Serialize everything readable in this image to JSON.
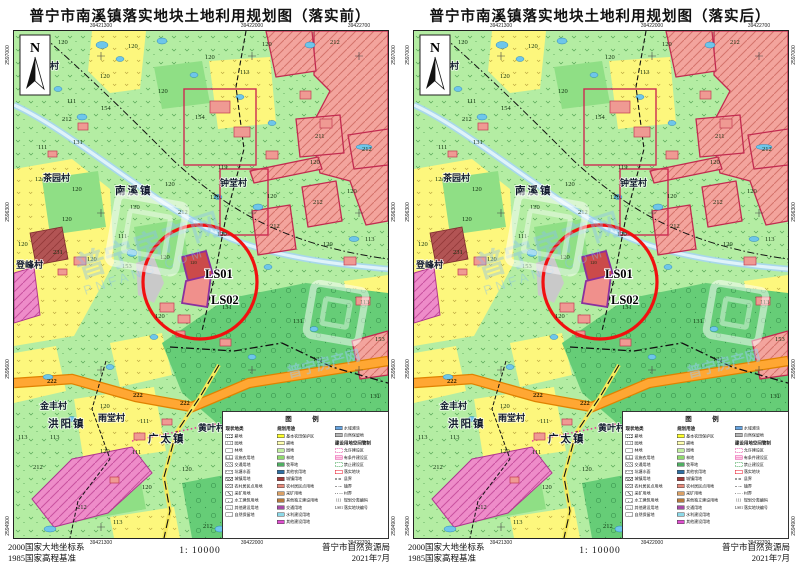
{
  "panels": [
    {
      "title": "普宁市南溪镇落实地块土地利用规划图（落实前）"
    },
    {
      "title": "普宁市南溪镇落实地块土地利用规划图（落实后）"
    }
  ],
  "map": {
    "north_label": "N",
    "top_coords": [
      "39421300",
      "39422000",
      "39422700"
    ],
    "bottom_coords": [
      "39421300",
      "39422000",
      "39422700"
    ],
    "left_coords": [
      "2597000",
      "2596300",
      "2595600",
      "2594900"
    ],
    "right_coords": [
      "2597000",
      "2596300",
      "2595600",
      "2594900"
    ],
    "labels": [
      [
        44,
        13,
        "120",
        "n"
      ],
      [
        114,
        17,
        "120",
        "n"
      ],
      [
        191,
        28,
        "120",
        "n"
      ],
      [
        248,
        15,
        "120",
        "n"
      ],
      [
        316,
        13,
        "212",
        "n"
      ],
      [
        226,
        43,
        "113",
        "n"
      ],
      [
        86,
        47,
        "120",
        "n"
      ],
      [
        144,
        62,
        "120",
        "n"
      ],
      [
        53,
        72,
        "111",
        "n"
      ],
      [
        87,
        79,
        "154",
        "n"
      ],
      [
        48,
        90,
        "212",
        "n"
      ],
      [
        24,
        118,
        "111",
        "n"
      ],
      [
        59,
        113,
        "131",
        "n"
      ],
      [
        181,
        88,
        "154",
        "n"
      ],
      [
        21,
        150,
        "120",
        "n"
      ],
      [
        58,
        160,
        "120",
        "n"
      ],
      [
        151,
        155,
        "120",
        "n"
      ],
      [
        164,
        183,
        "212",
        "n"
      ],
      [
        116,
        178,
        "120",
        "n"
      ],
      [
        48,
        190,
        "120",
        "n"
      ],
      [
        104,
        207,
        "111",
        "n"
      ],
      [
        39,
        223,
        "231",
        "n"
      ],
      [
        4,
        215,
        "120",
        "n"
      ],
      [
        73,
        230,
        "120",
        "n"
      ],
      [
        108,
        237,
        "153",
        "n"
      ],
      [
        146,
        228,
        "120",
        "n"
      ],
      [
        203,
        205,
        "120",
        "n"
      ],
      [
        208,
        278,
        "131",
        "n"
      ],
      [
        141,
        287,
        "120",
        "n"
      ],
      [
        204,
        138,
        "113",
        "n"
      ],
      [
        196,
        168,
        "120",
        "n"
      ],
      [
        253,
        167,
        "120",
        "n"
      ],
      [
        296,
        133,
        "120",
        "n"
      ],
      [
        333,
        162,
        "120",
        "n"
      ],
      [
        299,
        173,
        "212",
        "n"
      ],
      [
        256,
        197,
        "212",
        "n"
      ],
      [
        351,
        210,
        "113",
        "n"
      ],
      [
        309,
        215,
        "120",
        "n"
      ],
      [
        346,
        273,
        "113",
        "n"
      ],
      [
        279,
        292,
        "131",
        "n"
      ],
      [
        361,
        310,
        "153",
        "n"
      ],
      [
        299,
        330,
        "131",
        "n"
      ],
      [
        356,
        367,
        "131",
        "n"
      ],
      [
        301,
        107,
        "211",
        "n"
      ],
      [
        348,
        120,
        "212",
        "n"
      ],
      [
        33,
        352,
        "222",
        "r"
      ],
      [
        119,
        366,
        "222",
        "r"
      ],
      [
        166,
        374,
        "222",
        "r"
      ],
      [
        4,
        408,
        "113",
        "n"
      ],
      [
        36,
        408,
        "113",
        "n"
      ],
      [
        19,
        438,
        "212",
        "n"
      ],
      [
        86,
        377,
        "120",
        "n"
      ],
      [
        126,
        392,
        "111",
        "n"
      ],
      [
        118,
        423,
        "111",
        "n"
      ],
      [
        86,
        422,
        "120",
        "n"
      ],
      [
        168,
        440,
        "120",
        "n"
      ],
      [
        128,
        458,
        "120",
        "n"
      ],
      [
        63,
        478,
        "212",
        "n"
      ],
      [
        99,
        493,
        "113",
        "n"
      ],
      [
        189,
        497,
        "212",
        "n"
      ],
      [
        176,
        233,
        "120",
        "tiny"
      ],
      [
        18,
        38,
        "麻竹村",
        "v"
      ],
      [
        29,
        150,
        "茶园村",
        "v"
      ],
      [
        101,
        163,
        "南溪镇",
        "t"
      ],
      [
        206,
        155,
        "钟堂村",
        "v"
      ],
      [
        2,
        237,
        "登峰村",
        "v"
      ],
      [
        26,
        378,
        "金丰村",
        "v"
      ],
      [
        34,
        396,
        "洪阳镇",
        "t"
      ],
      [
        84,
        390,
        "雨堂村",
        "v"
      ],
      [
        134,
        411,
        "广太镇",
        "t"
      ],
      [
        184,
        400,
        "黄叶村",
        "v"
      ],
      [
        191,
        247,
        "LS01",
        "ls"
      ],
      [
        197,
        273,
        "LS02",
        "ls"
      ]
    ]
  },
  "legend": {
    "title": "图　例",
    "col1_header": "现状地类",
    "col1": [
      {
        "label": "耕地",
        "pat": "p-till"
      },
      {
        "label": "园地",
        "pat": "p-orch"
      },
      {
        "label": "林地",
        "pat": "p-forest"
      },
      {
        "label": "设施农用地",
        "pat": "p-fac"
      },
      {
        "label": "交通用地",
        "pat": "p-road"
      },
      {
        "label": "坑塘水面",
        "pat": "p-pond"
      },
      {
        "label": "城镇用地",
        "pat": "p-city"
      },
      {
        "label": "农村居民点用地",
        "pat": "p-vill"
      },
      {
        "label": "采矿用地",
        "pat": "p-mine"
      },
      {
        "label": "水工建筑用地",
        "pat": "p-hydro"
      },
      {
        "label": "其他建设用地",
        "pat": "p-other"
      },
      {
        "label": "自然保留地",
        "pat": "p-nat"
      }
    ],
    "col2_header": "规划用途",
    "col2": [
      {
        "label": "基本农田保护区",
        "color": "#ffff2e"
      },
      {
        "label": "耕地",
        "color": "#ffffb0"
      },
      {
        "label": "园地",
        "color": "#c2f0a2"
      },
      {
        "label": "林地",
        "color": "#8fd96b"
      },
      {
        "label": "牧草地",
        "color": "#4fae63"
      },
      {
        "label": "其他农用地",
        "color": "#2e6fa3"
      },
      {
        "label": "城镇用地",
        "color": "#a33c3c"
      },
      {
        "label": "农村居民点用地",
        "color": "#e88c7d"
      },
      {
        "label": "采矿用地",
        "color": "#d9a066"
      },
      {
        "label": "其他独立建设用地",
        "color": "#b5793e"
      },
      {
        "label": "交通用地",
        "color": "#a64ca6"
      },
      {
        "label": "水利建设用地",
        "color": "#8cd9e8"
      },
      {
        "label": "其他建设用地",
        "color": "#e04fd0"
      }
    ],
    "col3_top": [
      {
        "label": "水域滩涂",
        "color": "#66a3e0"
      },
      {
        "label": "自然保留地",
        "color": "#b8b8b8"
      }
    ],
    "col3_header": "建设用地空间管制",
    "zones": [
      {
        "label": "允许建设区",
        "style": "z-allow"
      },
      {
        "label": "有条件建设区",
        "style": "z-cond"
      },
      {
        "label": "禁止建设区",
        "style": "z-forbid"
      },
      {
        "label": "落实地块",
        "style": "z-parcel"
      }
    ],
    "boundaries": [
      {
        "label": "县界",
        "style": "b-county"
      },
      {
        "label": "镇界",
        "style": "b-town"
      },
      {
        "label": "村界",
        "style": "b-village"
      }
    ],
    "codes": [
      {
        "key": "111",
        "label": "规划分类编码"
      },
      {
        "key": "LS01",
        "label": "落实地块编号"
      }
    ]
  },
  "footer": {
    "datum_line1": "2000国家大地坐标系",
    "datum_line2": "1985国家高程基准",
    "scale": "1: 10000",
    "agency": "普宁市自然资源局",
    "date": "2021年7月"
  },
  "watermark": {
    "cn": "普宁房产网",
    "en": "PNFANG.COM"
  },
  "colors": {
    "field_green": "#b4eda3",
    "yellow": "#fdf77d",
    "forest": "#66cd77",
    "urban": "#f3a49d",
    "urban_border": "#c22b50",
    "magenta": "#ee8cc9",
    "road_orange": "#ff9d2e",
    "river": "#bfe4f2",
    "focus_red": "#f11010",
    "parcel_purple": "#8a2f9e"
  }
}
